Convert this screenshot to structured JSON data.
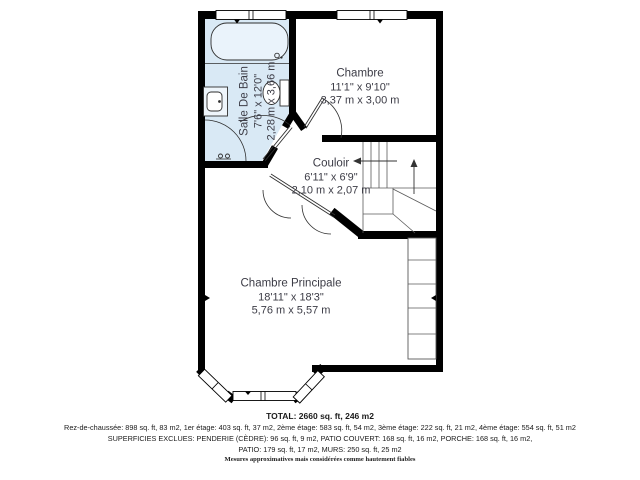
{
  "plan": {
    "rooms": {
      "bathroom": {
        "name": "Salle De Bain",
        "imperial": "7'6\" x 12'0\"",
        "metric": "2,28 m x 3,66 m"
      },
      "bedroom": {
        "name": "Chambre",
        "imperial": "11'1\" x 9'10\"",
        "metric": "3,37 m x 3,00 m"
      },
      "hallway": {
        "name": "Couloir",
        "imperial": "6'11\" x 6'9\"",
        "metric": "2,10 m x 2,07 m"
      },
      "master_bedroom": {
        "name": "Chambre Principale",
        "imperial": "18'11\" x 18'3\"",
        "metric": "5,76 m x 5,57 m"
      }
    },
    "colors": {
      "wall": "#000000",
      "bathroom_floor": "#d9e9f5",
      "label_text": "#3c3c46",
      "thin_line": "#2f2f2f"
    }
  },
  "summary": {
    "total": "TOTAL: 2660 sq. ft, 246 m2",
    "floors": "Rez-de-chaussée: 898 sq. ft, 83 m2, 1er étage: 403 sq. ft, 37 m2, 2ème étage: 583 sq. ft, 54 m2, 3ème étage: 222 sq. ft, 21 m2, 4ème étage: 554 sq. ft, 51 m2",
    "excluded_line1": "SUPERFICIES EXCLUES: PENDERIE (CÈDRE): 96 sq. ft, 9 m2, PATIO COUVERT: 168 sq. ft, 16 m2, PORCHE: 168 sq. ft, 16 m2,",
    "excluded_line2": "PATIO: 179 sq. ft, 17 m2, MURS: 250 sq. ft, 25 m2",
    "disclaimer": "Mesures approximatives mais considérées comme hautement fiables"
  }
}
